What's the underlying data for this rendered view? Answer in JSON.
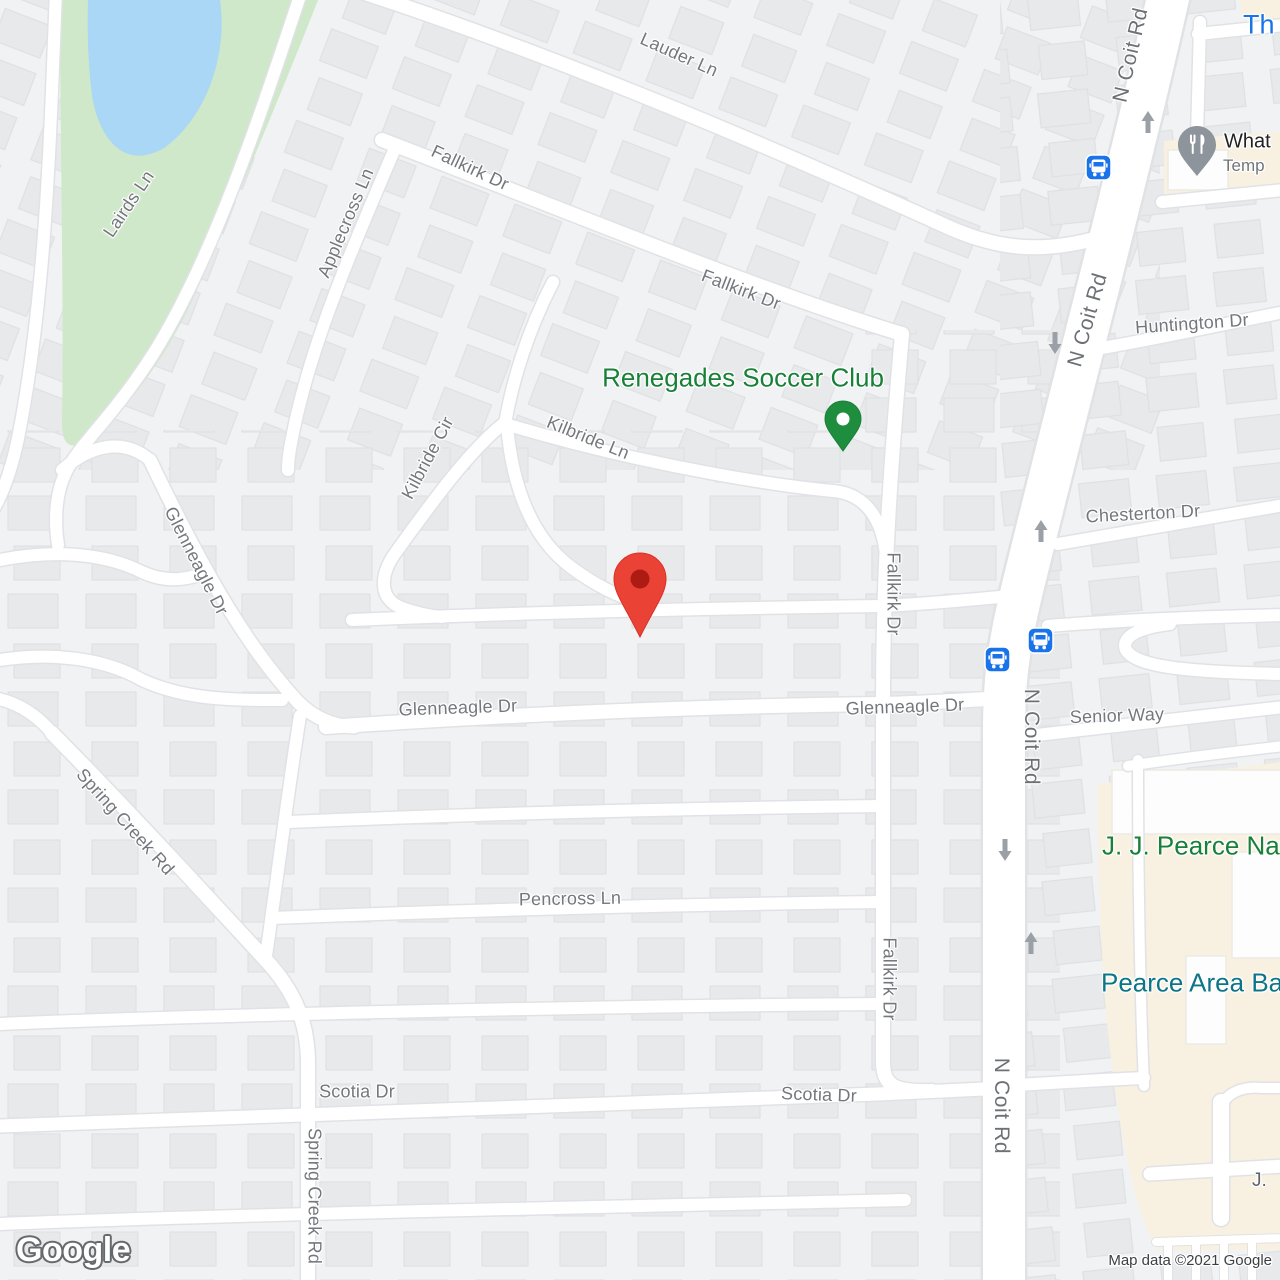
{
  "attribution": {
    "text": "Map data ©2021 Google"
  },
  "logo": {
    "text": "Google"
  },
  "streets": [
    {
      "text": "Lauder Ln"
    },
    {
      "text": "Fallkirk Dr"
    },
    {
      "text": "Fallkirk Dr"
    },
    {
      "text": "Applecross Ln"
    },
    {
      "text": "Lairds Ln"
    },
    {
      "text": "Kilbride Cir"
    },
    {
      "text": "Kilbride Ln"
    },
    {
      "text": "Glenneagle Dr"
    },
    {
      "text": "Glenneagle Dr"
    },
    {
      "text": "Glenneagle Dr"
    },
    {
      "text": "Spring Creek Rd"
    },
    {
      "text": "Spring Creek Rd"
    },
    {
      "text": "Pencross Ln"
    },
    {
      "text": "Scotia Dr"
    },
    {
      "text": "Scotia Dr"
    },
    {
      "text": "Fallkirk Dr"
    },
    {
      "text": "Fallkirk Dr"
    },
    {
      "text": "N Coit Rd"
    },
    {
      "text": "N Coit Rd"
    },
    {
      "text": "N Coit Rd"
    },
    {
      "text": "N Coit Rd"
    },
    {
      "text": "Huntington Dr"
    },
    {
      "text": "Chesterton Dr"
    },
    {
      "text": "Senior Way"
    }
  ],
  "pois": {
    "renegades": {
      "name": "Renegades Soccer Club",
      "marker": "green-pin-icon"
    },
    "top_right_truncated": {
      "name": "Th"
    },
    "restaurant": {
      "line1": "What",
      "line2": "Temp",
      "marker": "restaurant-pin-icon"
    },
    "natatorium": {
      "name": "J. J. Pearce Natat"
    },
    "pearce_area": {
      "name": "Pearce Area Ba"
    },
    "school_truncated": {
      "name": "J."
    }
  },
  "markers": {
    "destination": {
      "icon": "red-pin-icon"
    },
    "bus_stops": {
      "icon": "bus-stop-icon",
      "count": 3
    },
    "one_way_arrows": {
      "icon": "one-way-arrow-icon",
      "count": 5
    }
  },
  "colors": {
    "land": "#f1f2f4",
    "road": "#ffffff",
    "park": "#cfe8c9",
    "water": "#a9d7f5",
    "school_area": "#f8f1e1",
    "street_label": "#74787e",
    "poi_green": "#188038",
    "poi_blue": "#1a73e8",
    "poi_teal": "#0c7688",
    "pin_red": "#ea4335",
    "pin_green": "#1e8e3e",
    "pin_gray": "#8e949b",
    "transit_blue": "#1a73e8"
  }
}
